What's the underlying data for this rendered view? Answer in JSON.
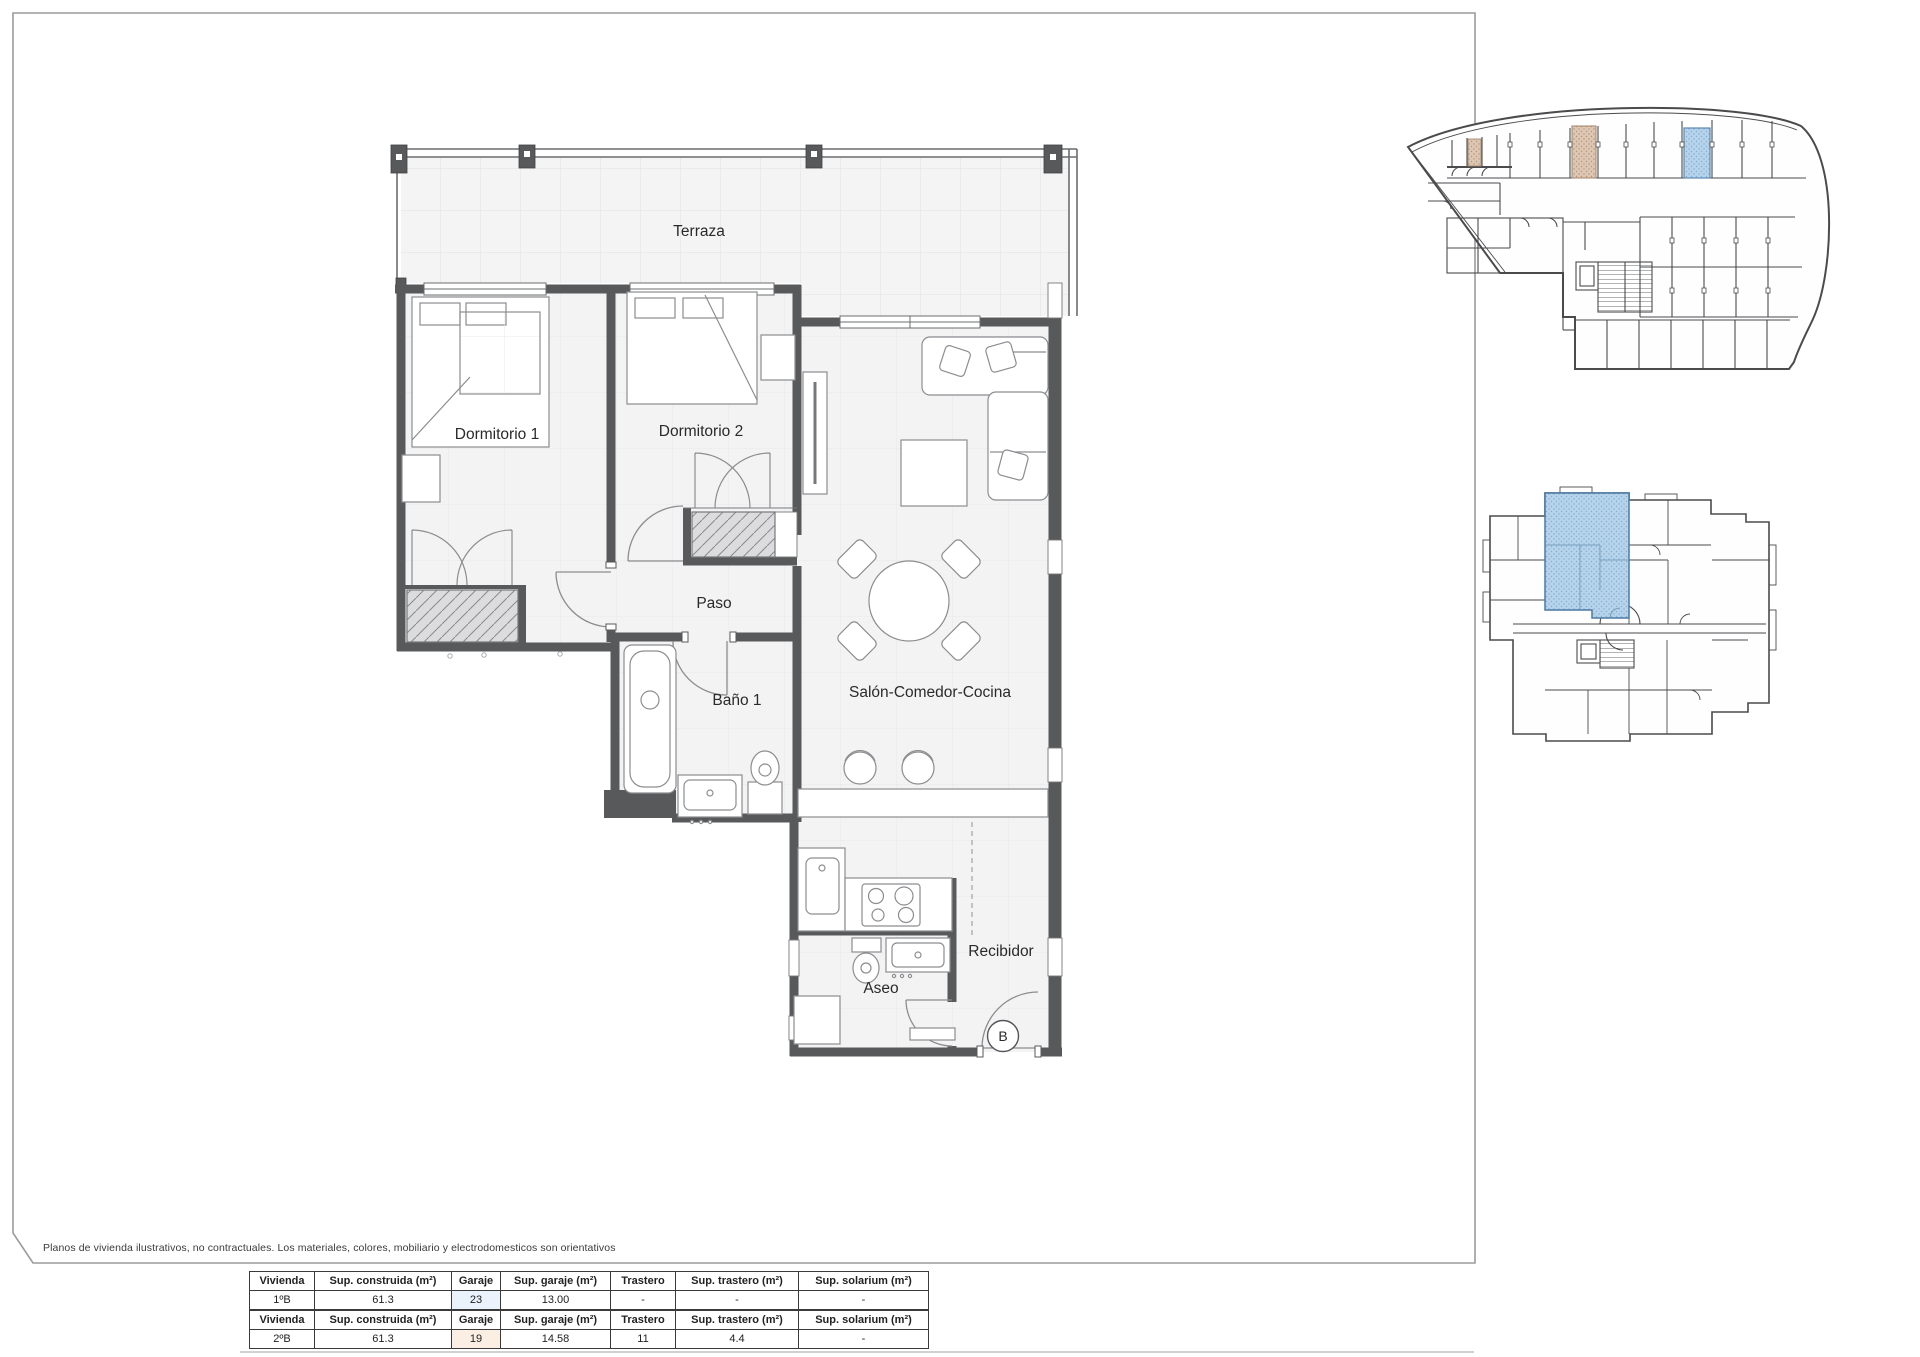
{
  "page": {
    "disclaimer": "Planos de vivienda ilustrativos, no contractuales. Los materiales, colores, mobiliario y electrodomesticos son orientativos"
  },
  "floorplan": {
    "rooms": {
      "terraza": "Terraza",
      "dormitorio_1": "Dormitorio 1",
      "dormitorio_2": "Dormitorio 2",
      "paso": "Paso",
      "bano_1": "Baño 1",
      "salon": "Salón-Comedor-Cocina",
      "aseo": "Aseo",
      "recibidor": "Recibidor"
    },
    "unit_letter": "B"
  },
  "colors": {
    "wall": "#58595b",
    "highlight_blue": "#b5d3ea",
    "highlight_blue_border": "#4d79a4",
    "highlight_tan": "#ddc6b2",
    "highlight_tan_border": "#a08468"
  },
  "tables": [
    {
      "headers": [
        "Vivienda",
        "Sup. construida (m²)",
        "Garaje",
        "Sup. garaje (m²)",
        "Trastero",
        "Sup. trastero (m²)",
        "Sup. solarium (m²)"
      ],
      "row": [
        "1ºB",
        "61.3",
        "23",
        "13.00",
        "-",
        "-",
        "-"
      ]
    },
    {
      "headers": [
        "Vivienda",
        "Sup. construida (m²)",
        "Garaje",
        "Sup. garaje (m²)",
        "Trastero",
        "Sup. trastero (m²)",
        "Sup. solarium (m²)"
      ],
      "row": [
        "2ºB",
        "61.3",
        "19",
        "14.58",
        "11",
        "4.4",
        "-"
      ]
    }
  ]
}
